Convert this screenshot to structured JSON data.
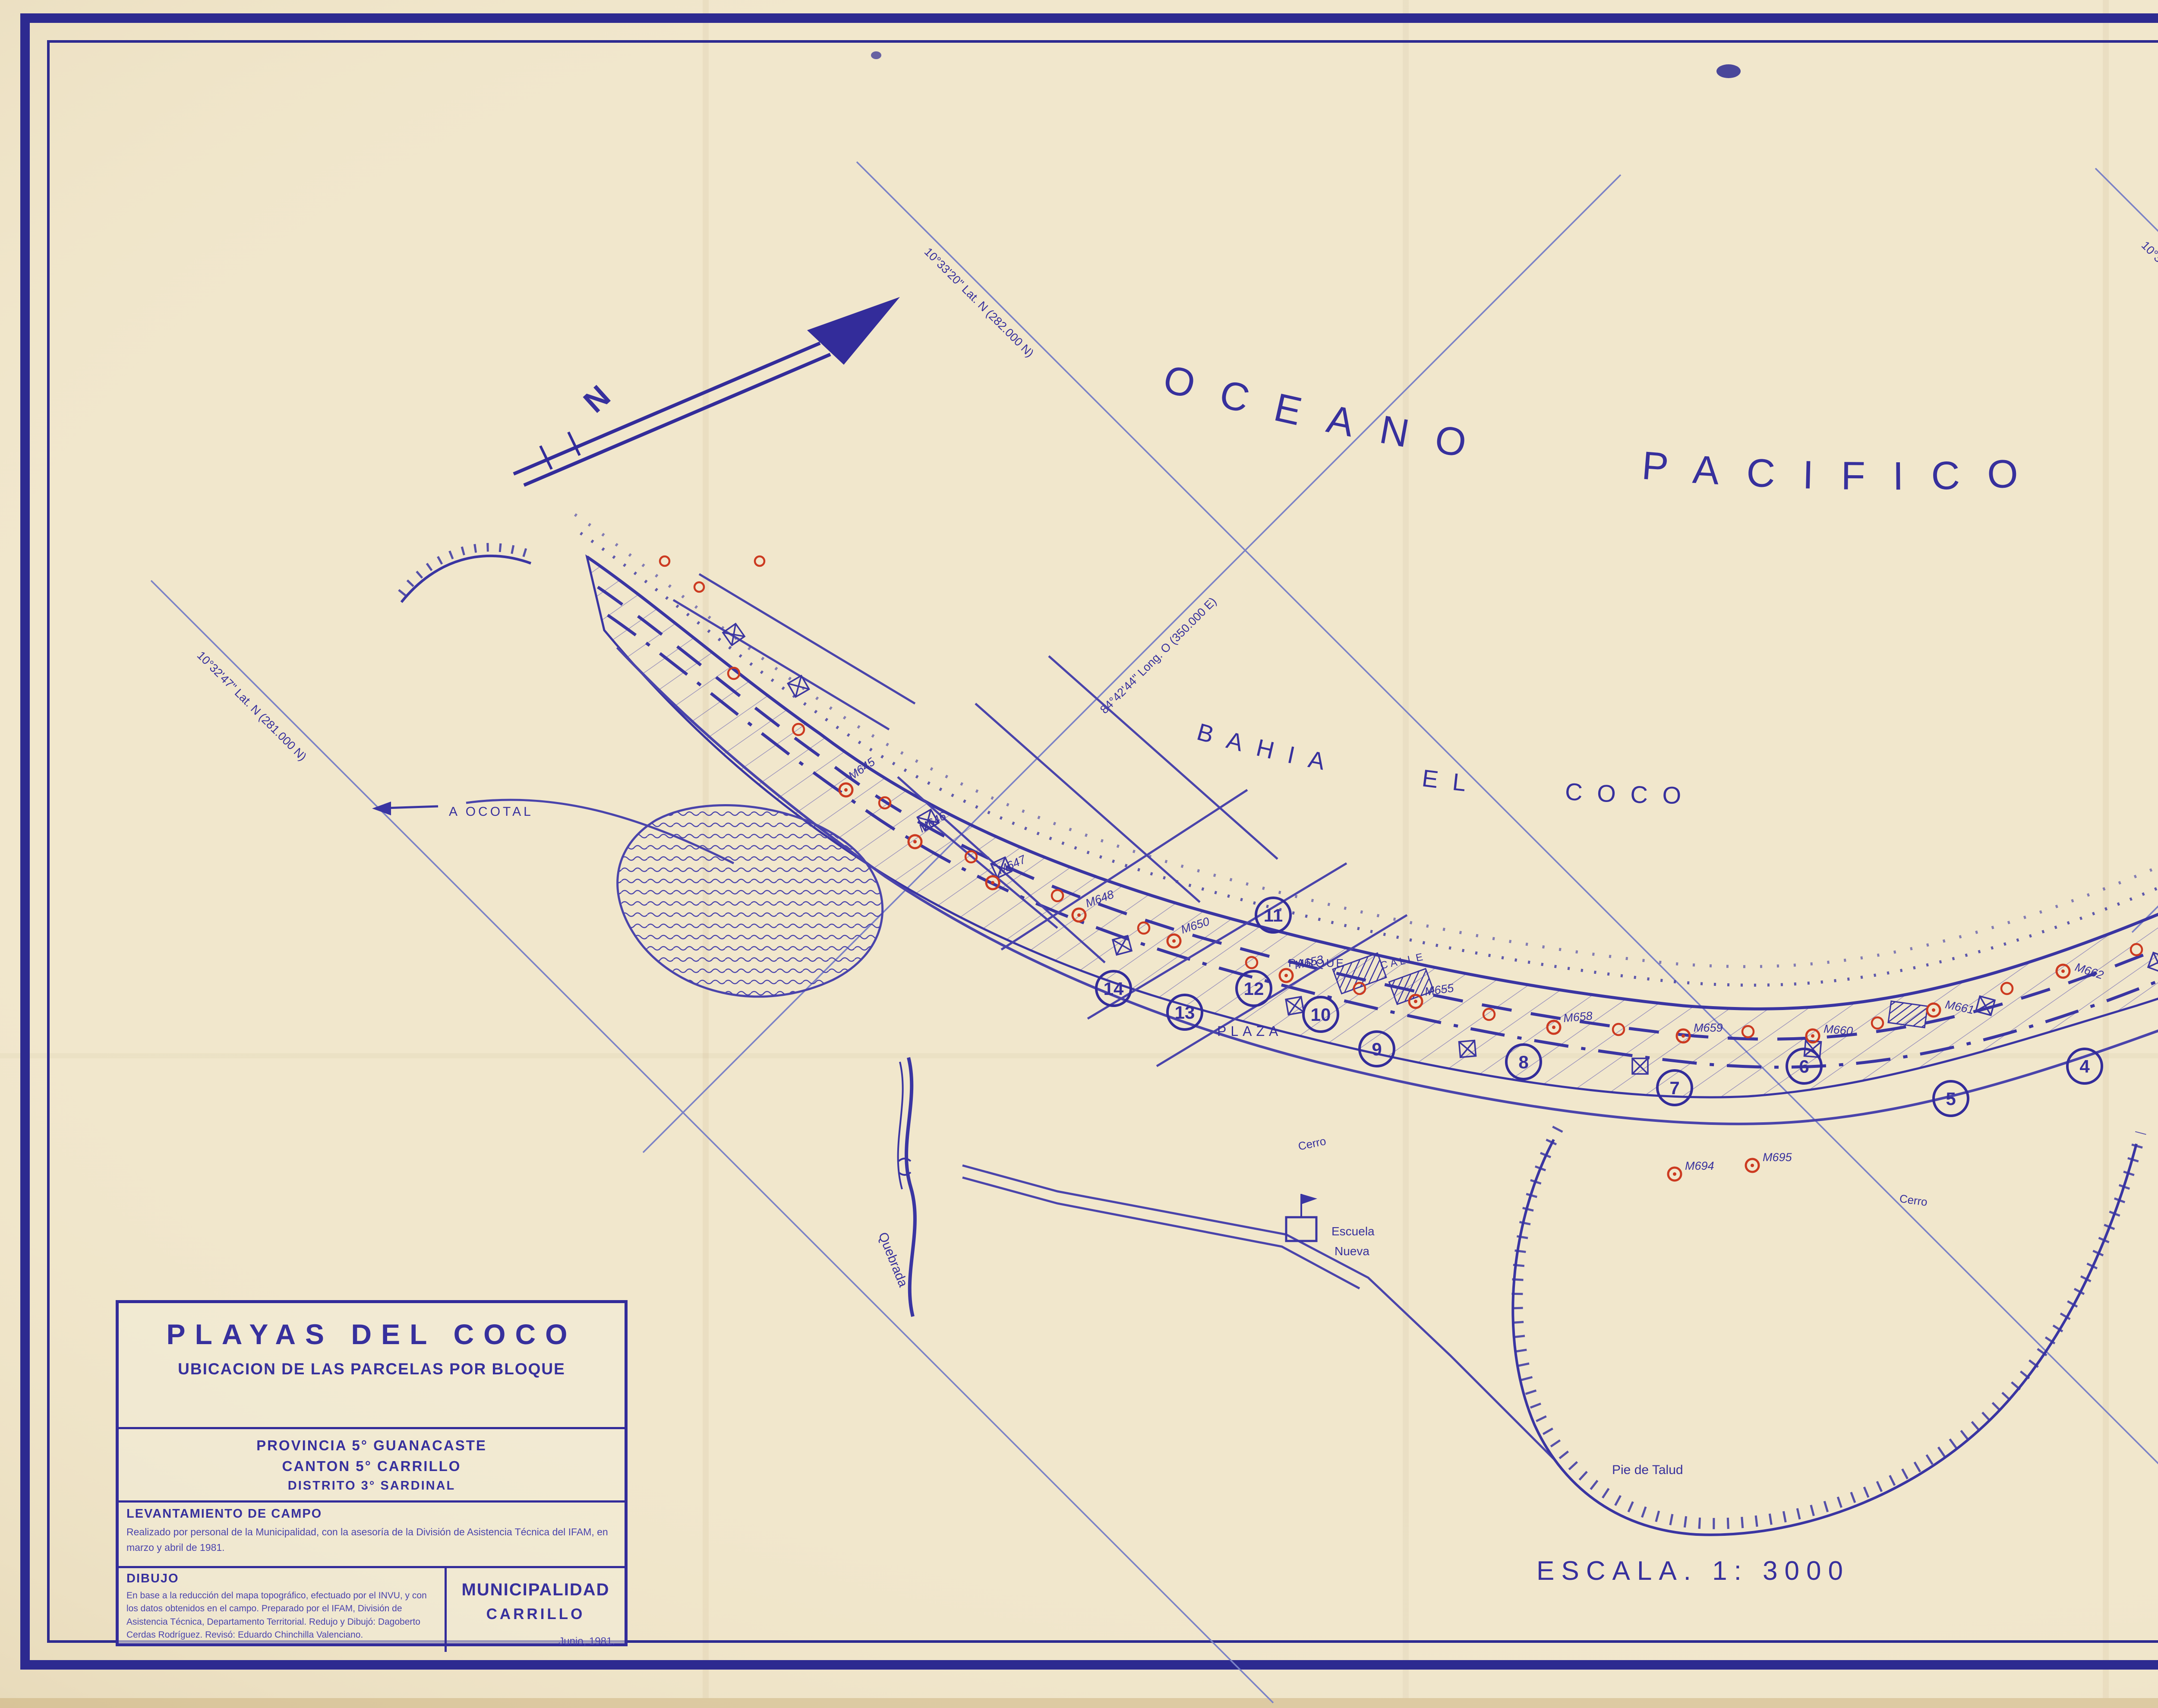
{
  "map": {
    "ocean_label": "OCEANO PACIFICO",
    "bay_label": "BAHIA EL COCO",
    "scale_label": "ESCALA.  1: 3000",
    "north_label": "N",
    "grid_labels": {
      "lat_281": "10°32'47\" Lat. N (281.000 N)",
      "lat_282": "10°33'20\" Lat. N (282.000 N)",
      "lat_283": "10°33'53\" Lat. N (283.000 N)",
      "long_350": "84°42'44\" Long. O (350.000 E)",
      "long_351": "84°41'43\" Long. O (351.000 E)"
    },
    "place_labels": {
      "plaza": "PLAZA",
      "parque": "PARQUE",
      "calle": "CALLE",
      "quebrada": "Quebrada",
      "escuela1": "Escuela",
      "escuela2": "Nueva",
      "a_ocotal": "A  OCOTAL",
      "pie_de_talud": "Pie de Talud",
      "cerro": "Cerro",
      "street_manuel": "C. Manuel Campos"
    },
    "blocks": [
      "1",
      "2",
      "3",
      "4",
      "5",
      "6",
      "7",
      "8",
      "9",
      "10",
      "11",
      "12",
      "13",
      "14"
    ],
    "mojones": [
      "M645",
      "M646",
      "M647",
      "M648",
      "M650",
      "M653",
      "M655",
      "M658",
      "M659",
      "M660",
      "M661",
      "M662",
      "M663",
      "M664",
      "M665",
      "M666",
      "M667",
      "M694",
      "M695"
    ]
  },
  "title_block": {
    "title1": "PLAYAS DEL COCO",
    "title2": "UBICACION DE LAS PARCELAS POR BLOQUE",
    "provincia": "PROVINCIA 5° GUANACASTE",
    "canton": "CANTON 5° CARRILLO",
    "distrito": "DISTRITO 3° SARDINAL",
    "lev_heading": "LEVANTAMIENTO DE CAMPO",
    "lev_body": "Realizado por personal de la Municipalidad, con la asesoría de la División de Asistencia Técnica del IFAM, en marzo y abril de 1981.",
    "dibujo_heading": "DIBUJO",
    "dibujo_body": "En base a la reducción del mapa topográfico, efectuado por el INVU, y con los datos obtenidos en el campo. Preparado por el IFAM, División de Asistencia Técnica, Departamento Territorial. Redujo y Dibujó: Dagoberto Cerdas Rodríguez. Revisó: Eduardo Chinchilla Valenciano.",
    "muni1": "MUNICIPALIDAD",
    "muni2": "CARRILLO",
    "date": "Junio, 1981."
  },
  "legend": {
    "title": "SIMBOLOGIA",
    "items": [
      {
        "symbol": "block-number-circle",
        "symbol_text": "1",
        "label": "Número del Bloque."
      },
      {
        "symbol": "parcel-number-square",
        "symbol_text": "1",
        "label": "Número de la Parcela"
      },
      {
        "symbol": "solid-line",
        "symbol_text": "",
        "label": "Lindero de la Parcela"
      },
      {
        "symbol": "mojon-triangle",
        "symbol_text": "N° 1",
        "label": "Mojón, Número"
      },
      {
        "symbol": "dashed-line",
        "symbol_text": "",
        "label": "Límite Zona Pública"
      },
      {
        "symbol": "dash-dot-line",
        "symbol_text": "",
        "label": "Límite Zona Restringida"
      },
      {
        "symbol": "hatched-square",
        "symbol_text": "",
        "label": "Construcciones Ubicadas en la Zona Pública"
      },
      {
        "symbol": "x-square",
        "symbol_text": "",
        "label": "Construcciones"
      },
      {
        "symbol": "dotted-square",
        "symbol_text": "",
        "label": "Playa"
      },
      {
        "symbol": "talud-symbol",
        "symbol_text": "",
        "label": "Pie de Talud"
      },
      {
        "symbol": "bridge-symbol",
        "symbol_text": "",
        "label": "Puente"
      },
      {
        "symbol": "waves-square",
        "symbol_text": "",
        "label": "Area Innundable"
      }
    ]
  },
  "stamps": {
    "ign": {
      "ring_top": "OBRAS PUBLICAS Y TRANSPORTES",
      "ring_bottom": "COSTA RICA",
      "inner_left": "INSTITUTO",
      "inner_top": "GEOGRAFICO",
      "inner_right": "NACIONAL",
      "inner_bottom": "JULIO 1944"
    },
    "ict": {
      "ring": "DIRECCION DE PLANEAMIENTO Y DESARROLLO TURISTICO *",
      "inner": "I. C. T."
    }
  },
  "notes": {
    "line1": "1981",
    "line2": "levantamiento parcelas",
    "line3": "El Coco"
  },
  "colors": {
    "ink": "#37309d",
    "ink_light": "#6a6fbe",
    "grid_blue": "#7b82c6",
    "red": "#cc3a20",
    "stamp_blue": "#2e8fd8",
    "stamp_gray": "#8f8d86",
    "pencil": "#7d95cc",
    "paper": "#f1e7cc"
  }
}
